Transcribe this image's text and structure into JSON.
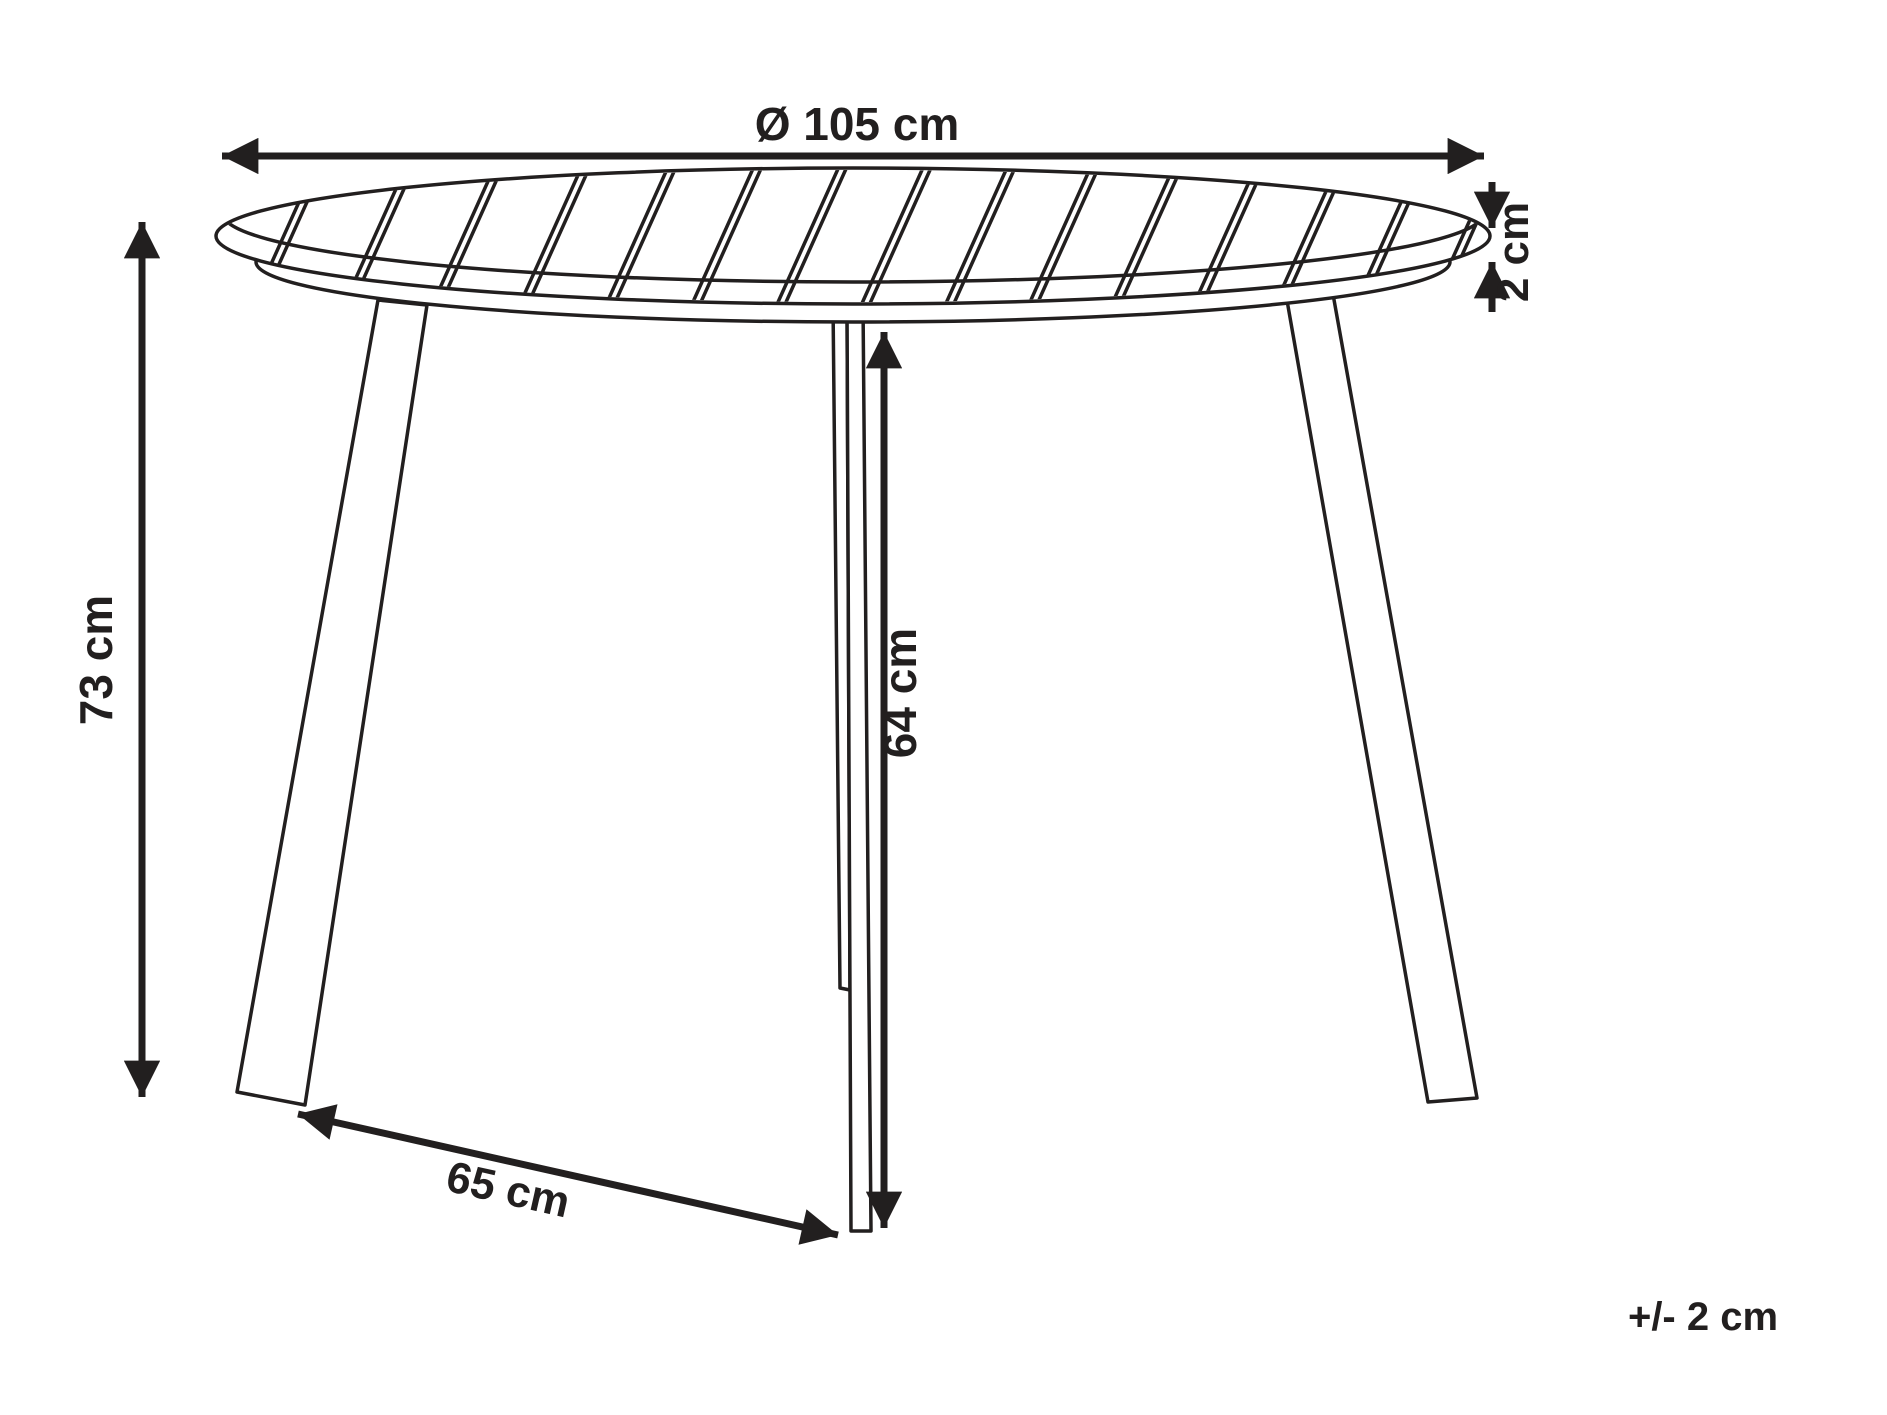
{
  "diagram": {
    "type": "product-dimension-drawing",
    "subject": "round-slatted-table-with-three-legs",
    "labels": {
      "diameter": "Ø 105 cm",
      "height": "73 cm",
      "top_thickness": "2 cm",
      "leg_height": "64 cm",
      "leg_spread": "65 cm",
      "tolerance": "+/- 2 cm"
    },
    "slats": {
      "count": 15
    },
    "colors": {
      "line": "#221f1f",
      "background": "#ffffff"
    }
  }
}
